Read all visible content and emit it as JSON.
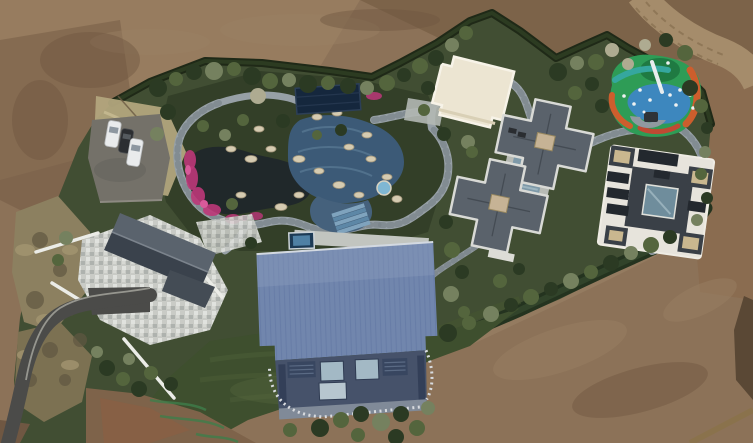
{
  "meta": {
    "title": "Aerial drone view of a landscaped estate with pond garden, pool, playground and five buildings surrounded by bare graded earth"
  },
  "features": {
    "bare_earth": "Bare graded earth surrounding the estate",
    "dirt_road": "Dirt access road at top right",
    "boundary_hedge": "Dark evergreen boundary hedge",
    "parking_area": "Small parking lot with three cars",
    "dry_scrub": "Dry scrub and pampas grass along west boundary",
    "garden_pond": "Dark ornamental pond with pink azalea borders",
    "pool_garden": "Rock-edged swimming pool garden",
    "pool_cover": "Navy pool cover panel",
    "garden_path": "Winding grey stone garden path",
    "left_house": "West house with grey gable roof and stone courtyard",
    "driveway": "Curved asphalt driveway",
    "barn_hall": "Large hall with standing-seam blue metal roof",
    "middle_villa": "Central villa with cross-shaped hip roofs",
    "right_villa": "East villa with white-trimmed dark roof and glass atrium",
    "white_pavilion": "Cream flat-roofed pavilion",
    "playground": "Colourful painted playground with slides",
    "stepping_path": "Stone stair path between villa and hall",
    "lawn": "Open green lawn",
    "trees": "Ornamental trees and shrubs"
  },
  "colors": {
    "dirt_base": "#8c7258",
    "dirt_light": "#977c5f",
    "dirt_dark": "#6e5740",
    "dirt_red": "#8a5f43",
    "dirt_road": "#a58c6b",
    "vegetation": "#414e33",
    "hedge": "#1f2917",
    "garden_bed": "#333f28",
    "lawn": "#3e4f2e",
    "lawn_stripe": "#4b5d37",
    "scrub": "#8c8060",
    "pampas": "#b2a57d",
    "path": "#97a0a6",
    "pond": "#20282a",
    "pool": "#3c5a77",
    "pool_tile": "#7fa3bd",
    "pool_cover": "#15273d",
    "spa_blue": "#7fb7d3",
    "rock": "#d5cbb1",
    "flower_pink": "#bd3779",
    "courtyard": "#c9cbc6",
    "wall_white": "#ebece7",
    "roof_gray": "#5a636d",
    "roof_gray_dark": "#3a424c",
    "barn_roof": "#7186ad",
    "facade": "#46526a",
    "glass": "#a3b9c5",
    "pavilion": "#ece5d2",
    "villa_roof": "#5a626b",
    "villa_trim": "#d9dad6",
    "villa_flat": "#b8bbb5",
    "skylight_tan": "#c6b395",
    "villa_pool": "#7e99a8",
    "rvilla_roof": "#3a4047",
    "rvilla_trim": "#e7e4dc",
    "atrium": "#6f8d9c",
    "dark_glass": "#23282e",
    "playground_green": "#2e9c56",
    "playground_blue": "#3e86c4",
    "playground_teal": "#35a79e",
    "playground_orange": "#cd5e2d",
    "playground_red": "#bf4a33",
    "ramp_gray": "#9099a0",
    "asphalt": "#747169",
    "driveway": "#4b4b49",
    "car_white": "#e9ebec",
    "car_dark": "#2c2e31",
    "shadow": "#51412f",
    "paint_green": "#3f7d4a"
  }
}
